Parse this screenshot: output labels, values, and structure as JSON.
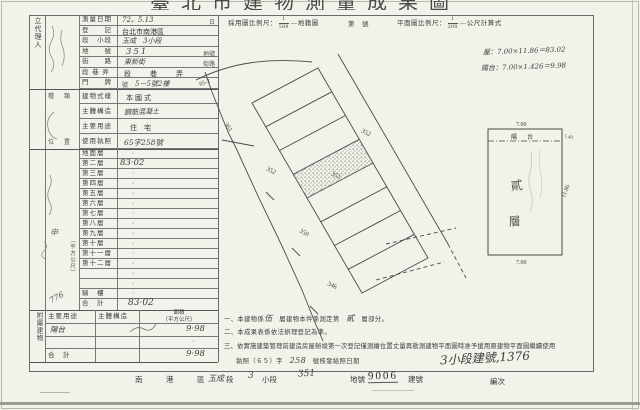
{
  "title": "臺北市建物測量成果圖",
  "colors": {
    "paper": "#f2f1ea",
    "ink": "#3a3a3a",
    "grid": "#6a6a6a",
    "handwriting": "#40403e"
  },
  "scale_header": {
    "left_label": "採用圖比例尺：",
    "left_num": "1",
    "left_den": "500",
    "left_suffix": "地籍圖",
    "mid": "第　號",
    "right_label": "平面圖比例尺：",
    "right_num": "1",
    "right_den": "200",
    "right_suffix": "公尺計算式"
  },
  "calc": {
    "line1": "屋：7.00×11.86＝83.02",
    "line2": "陽台：7.00×1.426＝9.98"
  },
  "form": {
    "agent_label": "立代理人",
    "section_b_label": "種　類",
    "location_label": "位　置",
    "sqm_vertical": "（平方公尺）",
    "shen": "申",
    "lot_hw": "776",
    "rows": [
      {
        "label": "測量日期",
        "value": "72。5.13",
        "suffix": "日"
      },
      {
        "label": "登　　記",
        "value": "台北市南港區",
        "suffix": ""
      },
      {
        "label": "段　小段",
        "value": "玉成　3小段",
        "suffix": ""
      },
      {
        "label": "地　　號",
        "value": "351",
        "suffix": "地號"
      },
      {
        "label": "街　　路",
        "value": "東新街",
        "suffix": "街路"
      },
      {
        "label": "段 巷 弄",
        "value": "段　巷　弄",
        "suffix": ""
      },
      {
        "label": "門　　牌",
        "value": "5－5號2樓",
        "suffix": "號"
      }
    ],
    "rows_b": [
      {
        "label": "建物式樣",
        "value": "本國式"
      },
      {
        "label": "主體構造",
        "value": "鋼筋混凝土"
      },
      {
        "label": "主要用途",
        "value": "住　宅"
      },
      {
        "label": "使用執照",
        "value": "65字258號"
      }
    ]
  },
  "floors": {
    "labels": [
      "地面層",
      "第二層",
      "第三層",
      "第四層",
      "第五層",
      "第六層",
      "第七層",
      "第八層",
      "第九層",
      "第十層",
      "第十一層",
      "第十二層",
      "",
      "",
      "騎　樓",
      "合　計"
    ],
    "values": [
      "·",
      "83·02",
      "·",
      "·",
      "·",
      "·",
      "·",
      "·",
      "·",
      "·",
      "·",
      "·",
      "·",
      "·",
      "·",
      "83·02"
    ]
  },
  "annex": {
    "side_label": "附屬建物",
    "h_use": "主要用途",
    "h_struct": "主體構造",
    "h_area1": "面積",
    "h_area2": "（平方公尺）",
    "row_use": "陽台",
    "row_area": "9·98",
    "blank_dot": "·",
    "total_label": "合　計",
    "total_area": "9·98"
  },
  "notes": {
    "n1a": "一、本建物係",
    "n1hw": "伍",
    "n1b": "層建物本件係測定第",
    "n1hw2": "貳",
    "n1c": "層部分。",
    "n2": "二、本成果表係依法辦理登記為準。",
    "n3": "三、依實施建築管理前建造房屋辦竣第一次登記僅測繪位置丈量再勘測建物平面圖時准予援用原建物平面圖繼續使用",
    "n4a": "執照（６５）字",
    "n4hw": "258",
    "n4b": "號核發給照日期",
    "margin_hw": "3小段建號,1376"
  },
  "bottom_row": {
    "district": "南　港　區",
    "hw_section": "玉成",
    "duan": "段",
    "hw_xiaoduan": "3",
    "xiaoduan": "小段",
    "hw_dihao": "351",
    "dihao": "地號",
    "hw_jianhao": "9006",
    "jianhao": "建號",
    "bianci": "編次"
  },
  "plot": {
    "labels": [
      {
        "t": "85-2"
      },
      {
        "t": "361"
      },
      {
        "t": "352"
      },
      {
        "t": "351"
      },
      {
        "t": "352"
      },
      {
        "t": "350"
      },
      {
        "t": "346"
      }
    ]
  },
  "rect": {
    "top": "7.00",
    "balcony": "陽　台",
    "right_small": "1.40",
    "right": "11.86",
    "bottom": "7.00",
    "floor1": "貳",
    "floor2": "層"
  }
}
